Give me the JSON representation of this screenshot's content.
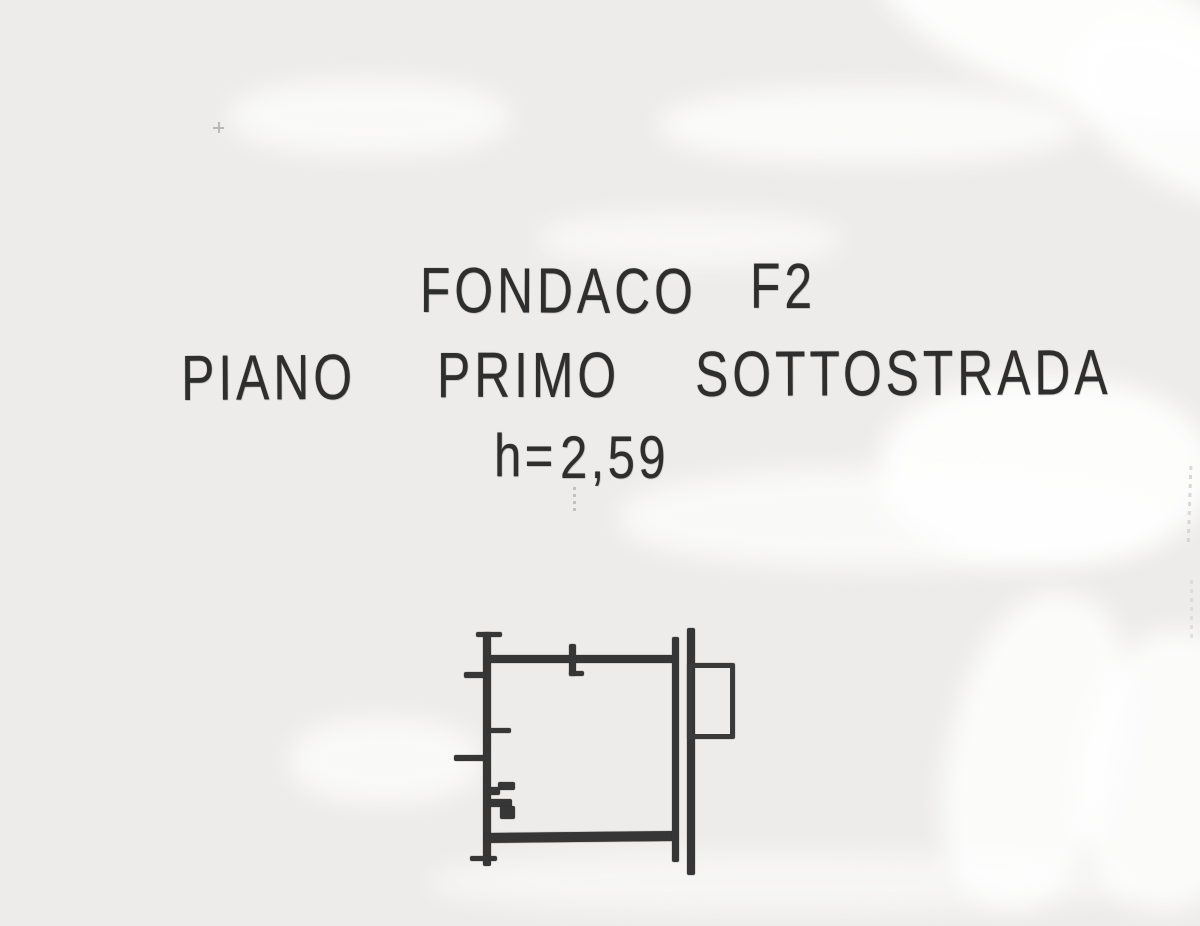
{
  "colors": {
    "paper": "#edecea",
    "ink": "#2e2e2e",
    "streak": "#ffffff",
    "faint_marks": "#cfcfcf"
  },
  "heading": {
    "building": "FONDACO",
    "unit": "F2",
    "floor": {
      "w1": "PIANO",
      "w2": "PRIMO",
      "w3": "SOTTOSTRADA"
    },
    "height_label": "h=",
    "height_value": "2,59"
  }
}
